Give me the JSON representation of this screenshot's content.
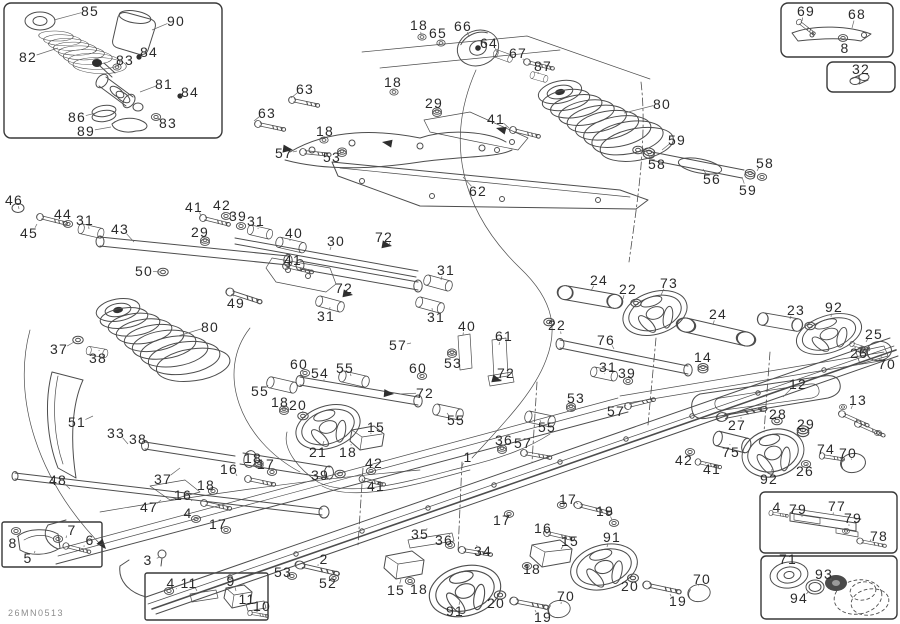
{
  "meta": {
    "drawing_code": "26MN0513",
    "description": "Exploded rear suspension parts diagram"
  },
  "colors": {
    "line": "#4d4d4d",
    "label": "#2b2b2b",
    "code_text": "#8d8d8d",
    "background": "#ffffff"
  },
  "diagram": {
    "labels": [
      {
        "t": "85",
        "x": 90,
        "y": 11,
        "lx": 54,
        "ly": 20
      },
      {
        "t": "90",
        "x": 176,
        "y": 21,
        "lx": 152,
        "ly": 30
      },
      {
        "t": "82",
        "x": 28,
        "y": 57,
        "lx": 58,
        "ly": 48
      },
      {
        "t": "83",
        "x": 125,
        "y": 60,
        "lx": 118,
        "ly": 67
      },
      {
        "t": "84",
        "x": 149,
        "y": 52,
        "lx": 141,
        "ly": 57
      },
      {
        "t": "81",
        "x": 164,
        "y": 84,
        "lx": 140,
        "ly": 92
      },
      {
        "t": "84",
        "x": 190,
        "y": 92,
        "lx": 181,
        "ly": 96
      },
      {
        "t": "86",
        "x": 77,
        "y": 117,
        "lx": 96,
        "ly": 113
      },
      {
        "t": "83",
        "x": 168,
        "y": 123,
        "lx": 158,
        "ly": 118
      },
      {
        "t": "89",
        "x": 86,
        "y": 131,
        "lx": 111,
        "ly": 127
      },
      {
        "t": "69",
        "x": 806,
        "y": 11,
        "lx": 802,
        "ly": 21
      },
      {
        "t": "68",
        "x": 857,
        "y": 14,
        "lx": 852,
        "ly": 28
      },
      {
        "t": "8",
        "x": 845,
        "y": 48,
        "lx": 844,
        "ly": 41
      },
      {
        "t": "32",
        "x": 861,
        "y": 69,
        "lx": 858,
        "ly": 78
      },
      {
        "t": "18",
        "x": 419,
        "y": 25,
        "lx": 421,
        "ly": 35
      },
      {
        "t": "65",
        "x": 438,
        "y": 33,
        "lx": 440,
        "ly": 41
      },
      {
        "t": "66",
        "x": 463,
        "y": 26,
        "lx": 469,
        "ly": 37
      },
      {
        "t": "64",
        "x": 489,
        "y": 43,
        "lx": 497,
        "ly": 52
      },
      {
        "t": "67",
        "x": 518,
        "y": 53,
        "lx": 523,
        "ly": 60
      },
      {
        "t": "87",
        "x": 543,
        "y": 66,
        "lx": 538,
        "ly": 74
      },
      {
        "t": "80",
        "x": 662,
        "y": 104,
        "lx": 624,
        "ly": 113
      },
      {
        "t": "63",
        "x": 305,
        "y": 89,
        "lx": 291,
        "ly": 98
      },
      {
        "t": "18",
        "x": 393,
        "y": 82,
        "lx": 393,
        "ly": 91
      },
      {
        "t": "29",
        "x": 434,
        "y": 103,
        "lx": 437,
        "ly": 111
      },
      {
        "t": "41",
        "x": 496,
        "y": 119,
        "lx": 509,
        "ly": 128
      },
      {
        "t": "63",
        "x": 267,
        "y": 113,
        "lx": 254,
        "ly": 121
      },
      {
        "t": "18",
        "x": 325,
        "y": 131,
        "lx": 323,
        "ly": 139
      },
      {
        "t": "57",
        "x": 284,
        "y": 153,
        "lx": 297,
        "ly": 151
      },
      {
        "t": "53",
        "x": 332,
        "y": 157,
        "lx": 341,
        "ly": 152
      },
      {
        "t": "62",
        "x": 478,
        "y": 191,
        "lx": 463,
        "ly": 177
      },
      {
        "t": "59",
        "x": 677,
        "y": 140,
        "lx": 662,
        "ly": 150
      },
      {
        "t": "58",
        "x": 657,
        "y": 164,
        "lx": 648,
        "ly": 154
      },
      {
        "t": "58",
        "x": 765,
        "y": 163,
        "lx": 757,
        "ly": 171
      },
      {
        "t": "56",
        "x": 712,
        "y": 179,
        "lx": 703,
        "ly": 169
      },
      {
        "t": "59",
        "x": 748,
        "y": 190,
        "lx": 742,
        "ly": 177
      },
      {
        "t": "46",
        "x": 14,
        "y": 200,
        "lx": 19,
        "ly": 209
      },
      {
        "t": "44",
        "x": 63,
        "y": 214,
        "lx": 66,
        "ly": 221
      },
      {
        "t": "31",
        "x": 85,
        "y": 220,
        "lx": 89,
        "ly": 229
      },
      {
        "t": "43",
        "x": 120,
        "y": 229,
        "lx": 134,
        "ly": 242
      },
      {
        "t": "45",
        "x": 29,
        "y": 233,
        "lx": 37,
        "ly": 224
      },
      {
        "t": "41",
        "x": 194,
        "y": 207,
        "lx": 201,
        "ly": 216
      },
      {
        "t": "42",
        "x": 222,
        "y": 205,
        "lx": 224,
        "ly": 214
      },
      {
        "t": "39",
        "x": 238,
        "y": 216,
        "lx": 240,
        "ly": 224
      },
      {
        "t": "31",
        "x": 256,
        "y": 221,
        "lx": 258,
        "ly": 229
      },
      {
        "t": "29",
        "x": 200,
        "y": 232,
        "lx": 204,
        "ly": 239
      },
      {
        "t": "40",
        "x": 294,
        "y": 233,
        "lx": 290,
        "ly": 241
      },
      {
        "t": "50",
        "x": 144,
        "y": 271,
        "lx": 160,
        "ly": 272
      },
      {
        "t": "41",
        "x": 293,
        "y": 260,
        "lx": 284,
        "ly": 265
      },
      {
        "t": "49",
        "x": 236,
        "y": 303,
        "lx": 233,
        "ly": 293
      },
      {
        "t": "80",
        "x": 210,
        "y": 327,
        "lx": 178,
        "ly": 336
      },
      {
        "t": "37",
        "x": 59,
        "y": 349,
        "lx": 74,
        "ly": 342
      },
      {
        "t": "38",
        "x": 98,
        "y": 358,
        "lx": 99,
        "ly": 350
      },
      {
        "t": "30",
        "x": 336,
        "y": 241,
        "lx": 330,
        "ly": 250
      },
      {
        "t": "72",
        "x": 384,
        "y": 237,
        "lx": 390,
        "ly": 245
      },
      {
        "t": "31",
        "x": 446,
        "y": 270,
        "lx": 441,
        "ly": 280
      },
      {
        "t": "72",
        "x": 344,
        "y": 288,
        "lx": 351,
        "ly": 294
      },
      {
        "t": "31",
        "x": 326,
        "y": 316,
        "lx": 330,
        "ly": 307
      },
      {
        "t": "31",
        "x": 436,
        "y": 317,
        "lx": 432,
        "ly": 308
      },
      {
        "t": "40",
        "x": 467,
        "y": 326,
        "lx": 463,
        "ly": 335
      },
      {
        "t": "61",
        "x": 504,
        "y": 336,
        "lx": 499,
        "ly": 345
      },
      {
        "t": "57",
        "x": 398,
        "y": 345,
        "lx": 411,
        "ly": 343
      },
      {
        "t": "53",
        "x": 453,
        "y": 363,
        "lx": 452,
        "ly": 354
      },
      {
        "t": "60",
        "x": 299,
        "y": 364,
        "lx": 303,
        "ly": 373
      },
      {
        "t": "54",
        "x": 320,
        "y": 373,
        "lx": 324,
        "ly": 381
      },
      {
        "t": "55",
        "x": 345,
        "y": 368,
        "lx": 351,
        "ly": 376
      },
      {
        "t": "60",
        "x": 418,
        "y": 368,
        "lx": 421,
        "ly": 376
      },
      {
        "t": "55",
        "x": 260,
        "y": 391,
        "lx": 268,
        "ly": 385
      },
      {
        "t": "72",
        "x": 506,
        "y": 373,
        "lx": 501,
        "ly": 380
      },
      {
        "t": "72",
        "x": 425,
        "y": 393,
        "lx": 400,
        "ly": 394
      },
      {
        "t": "24",
        "x": 599,
        "y": 280,
        "lx": 591,
        "ly": 291
      },
      {
        "t": "22",
        "x": 628,
        "y": 289,
        "lx": 623,
        "ly": 299
      },
      {
        "t": "73",
        "x": 669,
        "y": 283,
        "lx": 661,
        "ly": 295
      },
      {
        "t": "24",
        "x": 718,
        "y": 314,
        "lx": 713,
        "ly": 325
      },
      {
        "t": "23",
        "x": 796,
        "y": 310,
        "lx": 790,
        "ly": 319
      },
      {
        "t": "92",
        "x": 834,
        "y": 307,
        "lx": 831,
        "ly": 317
      },
      {
        "t": "25",
        "x": 874,
        "y": 334,
        "lx": 866,
        "ly": 342
      },
      {
        "t": "26",
        "x": 859,
        "y": 353,
        "lx": 856,
        "ly": 348
      },
      {
        "t": "70",
        "x": 887,
        "y": 364,
        "lx": 881,
        "ly": 356
      },
      {
        "t": "22",
        "x": 557,
        "y": 325,
        "lx": 561,
        "ly": 334
      },
      {
        "t": "76",
        "x": 606,
        "y": 340,
        "lx": 614,
        "ly": 349
      },
      {
        "t": "31",
        "x": 608,
        "y": 367,
        "lx": 605,
        "ly": 374
      },
      {
        "t": "39",
        "x": 627,
        "y": 373,
        "lx": 624,
        "ly": 380
      },
      {
        "t": "14",
        "x": 703,
        "y": 357,
        "lx": 701,
        "ly": 365
      },
      {
        "t": "12",
        "x": 798,
        "y": 384,
        "lx": 783,
        "ly": 397
      },
      {
        "t": "13",
        "x": 858,
        "y": 400,
        "lx": 851,
        "ly": 409
      },
      {
        "t": "51",
        "x": 77,
        "y": 422,
        "lx": 93,
        "ly": 416
      },
      {
        "t": "33",
        "x": 116,
        "y": 433,
        "lx": 128,
        "ly": 444
      },
      {
        "t": "38",
        "x": 138,
        "y": 439,
        "lx": 142,
        "ly": 449
      },
      {
        "t": "37",
        "x": 163,
        "y": 479,
        "lx": 180,
        "ly": 468
      },
      {
        "t": "48",
        "x": 58,
        "y": 480,
        "lx": 70,
        "ly": 489
      },
      {
        "t": "47",
        "x": 149,
        "y": 507,
        "lx": 161,
        "ly": 500
      },
      {
        "t": "18",
        "x": 280,
        "y": 402,
        "lx": 284,
        "ly": 410
      },
      {
        "t": "20",
        "x": 298,
        "y": 405,
        "lx": 303,
        "ly": 413
      },
      {
        "t": "18",
        "x": 253,
        "y": 458,
        "lx": 259,
        "ly": 465
      },
      {
        "t": "17",
        "x": 266,
        "y": 464,
        "lx": 272,
        "ly": 471
      },
      {
        "t": "16",
        "x": 229,
        "y": 469,
        "lx": 237,
        "ly": 476
      },
      {
        "t": "18",
        "x": 206,
        "y": 485,
        "lx": 212,
        "ly": 491
      },
      {
        "t": "16",
        "x": 183,
        "y": 495,
        "lx": 192,
        "ly": 501
      },
      {
        "t": "4",
        "x": 188,
        "y": 513,
        "lx": 194,
        "ly": 519
      },
      {
        "t": "17",
        "x": 218,
        "y": 524,
        "lx": 225,
        "ly": 529
      },
      {
        "t": "7",
        "x": 72,
        "y": 530,
        "lx": 66,
        "ly": 538
      },
      {
        "t": "8",
        "x": 13,
        "y": 543,
        "lx": 17,
        "ly": 536
      },
      {
        "t": "6",
        "x": 90,
        "y": 540,
        "lx": 84,
        "ly": 547
      },
      {
        "t": "5",
        "x": 28,
        "y": 558,
        "lx": 35,
        "ly": 551
      },
      {
        "t": "3",
        "x": 148,
        "y": 560,
        "lx": 160,
        "ly": 557
      },
      {
        "t": "4",
        "x": 171,
        "y": 583,
        "lx": 176,
        "ly": 589
      },
      {
        "t": "11",
        "x": 189,
        "y": 583,
        "lx": 197,
        "ly": 591
      },
      {
        "t": "9",
        "x": 231,
        "y": 581,
        "lx": 236,
        "ly": 591
      },
      {
        "t": "11",
        "x": 247,
        "y": 599,
        "lx": 252,
        "ly": 603
      },
      {
        "t": "10",
        "x": 262,
        "y": 606,
        "lx": 258,
        "ly": 611
      },
      {
        "t": "53",
        "x": 283,
        "y": 572,
        "lx": 292,
        "ly": 575
      },
      {
        "t": "2",
        "x": 324,
        "y": 559,
        "lx": 318,
        "ly": 566
      },
      {
        "t": "52",
        "x": 328,
        "y": 583,
        "lx": 333,
        "ly": 577
      },
      {
        "t": "21",
        "x": 318,
        "y": 452,
        "lx": 324,
        "ly": 441
      },
      {
        "t": "18",
        "x": 348,
        "y": 452,
        "lx": 351,
        "ly": 444
      },
      {
        "t": "15",
        "x": 376,
        "y": 427,
        "lx": 371,
        "ly": 434
      },
      {
        "t": "42",
        "x": 374,
        "y": 463,
        "lx": 371,
        "ly": 470
      },
      {
        "t": "39",
        "x": 320,
        "y": 475,
        "lx": 330,
        "ly": 480
      },
      {
        "t": "41",
        "x": 376,
        "y": 486,
        "lx": 371,
        "ly": 480
      },
      {
        "t": "1",
        "x": 468,
        "y": 457,
        "lx": 462,
        "ly": 467
      },
      {
        "t": "55",
        "x": 456,
        "y": 420,
        "lx": 447,
        "ly": 413
      },
      {
        "t": "55",
        "x": 547,
        "y": 427,
        "lx": 540,
        "ly": 420
      },
      {
        "t": "36",
        "x": 504,
        "y": 440,
        "lx": 501,
        "ly": 447
      },
      {
        "t": "57",
        "x": 523,
        "y": 443,
        "lx": 522,
        "ly": 451
      },
      {
        "t": "35",
        "x": 420,
        "y": 534,
        "lx": 427,
        "ly": 528
      },
      {
        "t": "36",
        "x": 444,
        "y": 540,
        "lx": 449,
        "ly": 534
      },
      {
        "t": "34",
        "x": 483,
        "y": 551,
        "lx": 477,
        "ly": 545
      },
      {
        "t": "15",
        "x": 396,
        "y": 590,
        "lx": 401,
        "ly": 579
      },
      {
        "t": "18",
        "x": 419,
        "y": 589,
        "lx": 412,
        "ly": 582
      },
      {
        "t": "91",
        "x": 455,
        "y": 611,
        "lx": 460,
        "ly": 601
      },
      {
        "t": "20",
        "x": 496,
        "y": 603,
        "lx": 500,
        "ly": 596
      },
      {
        "t": "19",
        "x": 543,
        "y": 617,
        "lx": 535,
        "ly": 610
      },
      {
        "t": "70",
        "x": 566,
        "y": 596,
        "lx": 561,
        "ly": 604
      },
      {
        "t": "15",
        "x": 570,
        "y": 541,
        "lx": 561,
        "ly": 549
      },
      {
        "t": "18",
        "x": 532,
        "y": 569,
        "lx": 528,
        "ly": 562
      },
      {
        "t": "16",
        "x": 543,
        "y": 528,
        "lx": 546,
        "ly": 533
      },
      {
        "t": "17",
        "x": 502,
        "y": 520,
        "lx": 509,
        "ly": 514
      },
      {
        "t": "17",
        "x": 568,
        "y": 499,
        "lx": 578,
        "ly": 504
      },
      {
        "t": "19",
        "x": 605,
        "y": 511,
        "lx": 612,
        "ly": 520
      },
      {
        "t": "91",
        "x": 612,
        "y": 537,
        "lx": 607,
        "ly": 547
      },
      {
        "t": "20",
        "x": 630,
        "y": 586,
        "lx": 633,
        "ly": 579
      },
      {
        "t": "70",
        "x": 702,
        "y": 579,
        "lx": 699,
        "ly": 586
      },
      {
        "t": "19",
        "x": 678,
        "y": 601,
        "lx": 670,
        "ly": 594
      },
      {
        "t": "53",
        "x": 576,
        "y": 398,
        "lx": 571,
        "ly": 406
      },
      {
        "t": "57",
        "x": 616,
        "y": 411,
        "lx": 626,
        "ly": 405
      },
      {
        "t": "28",
        "x": 778,
        "y": 414,
        "lx": 774,
        "ly": 420
      },
      {
        "t": "29",
        "x": 806,
        "y": 424,
        "lx": 803,
        "ly": 430
      },
      {
        "t": "27",
        "x": 737,
        "y": 425,
        "lx": 741,
        "ly": 417
      },
      {
        "t": "75",
        "x": 731,
        "y": 452,
        "lx": 730,
        "ly": 444
      },
      {
        "t": "74",
        "x": 826,
        "y": 449,
        "lx": 830,
        "ly": 456
      },
      {
        "t": "70",
        "x": 848,
        "y": 453,
        "lx": 851,
        "ly": 459
      },
      {
        "t": "42",
        "x": 684,
        "y": 460,
        "lx": 690,
        "ly": 453
      },
      {
        "t": "41",
        "x": 712,
        "y": 469,
        "lx": 706,
        "ly": 463
      },
      {
        "t": "92",
        "x": 769,
        "y": 479,
        "lx": 772,
        "ly": 469
      },
      {
        "t": "26",
        "x": 805,
        "y": 471,
        "lx": 806,
        "ly": 465
      },
      {
        "t": "4",
        "x": 777,
        "y": 507,
        "lx": 773,
        "ly": 514
      },
      {
        "t": "79",
        "x": 798,
        "y": 509,
        "lx": 802,
        "ly": 517
      },
      {
        "t": "77",
        "x": 837,
        "y": 506,
        "lx": 833,
        "ly": 515
      },
      {
        "t": "79",
        "x": 853,
        "y": 518,
        "lx": 849,
        "ly": 526
      },
      {
        "t": "78",
        "x": 879,
        "y": 536,
        "lx": 870,
        "ly": 541
      },
      {
        "t": "71",
        "x": 788,
        "y": 559,
        "lx": 789,
        "ly": 566
      },
      {
        "t": "93",
        "x": 824,
        "y": 574,
        "lx": 831,
        "ly": 580
      },
      {
        "t": "94",
        "x": 799,
        "y": 598,
        "lx": 809,
        "ly": 591
      }
    ]
  }
}
